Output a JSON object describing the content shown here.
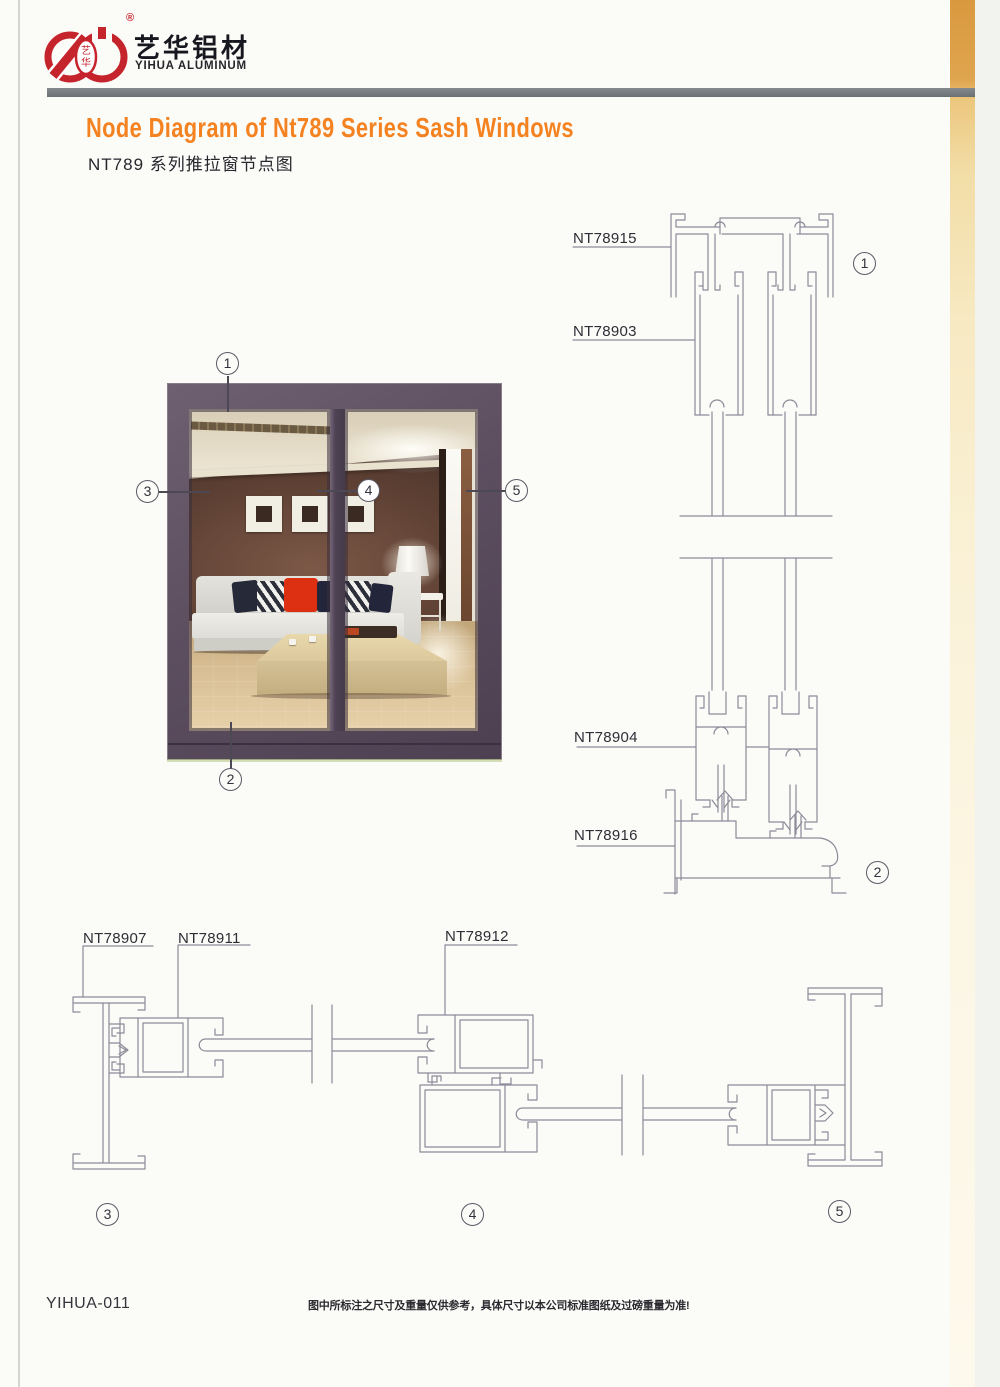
{
  "brand": {
    "name_cn": "艺华铝材",
    "name_en": "YIHUA ALUMINUM",
    "mark": "®",
    "logo_char_top": "艺",
    "logo_char_bottom": "华"
  },
  "heading": {
    "title_en": "Node Diagram of Nt789 Series Sash Windows",
    "title_cn": "NT789 系列推拉窗节点图"
  },
  "profiles": {
    "head_frame": "NT78915",
    "sash_top": "NT78903",
    "sash_bottom": "NT78904",
    "sill": "NT78916",
    "side_jamb": "NT78907",
    "glazing_sash": "NT78911",
    "meeting_stile": "NT78912"
  },
  "callouts": {
    "c1": "1",
    "c2": "2",
    "c3": "3",
    "c4": "4",
    "c5": "5"
  },
  "footer": {
    "doc_code": "YIHUA-011",
    "disclaimer": "图中所标注之尺寸及重量仅供参考，具体尺寸以本公司标准图纸及过磅重量为准!"
  },
  "colors": {
    "accent_orange": "#f58220",
    "logo_red": "#c5242c",
    "frame_purple": "#5a4c5c",
    "line_gray": "#8d8a98",
    "bar_gray": "#75797b"
  }
}
